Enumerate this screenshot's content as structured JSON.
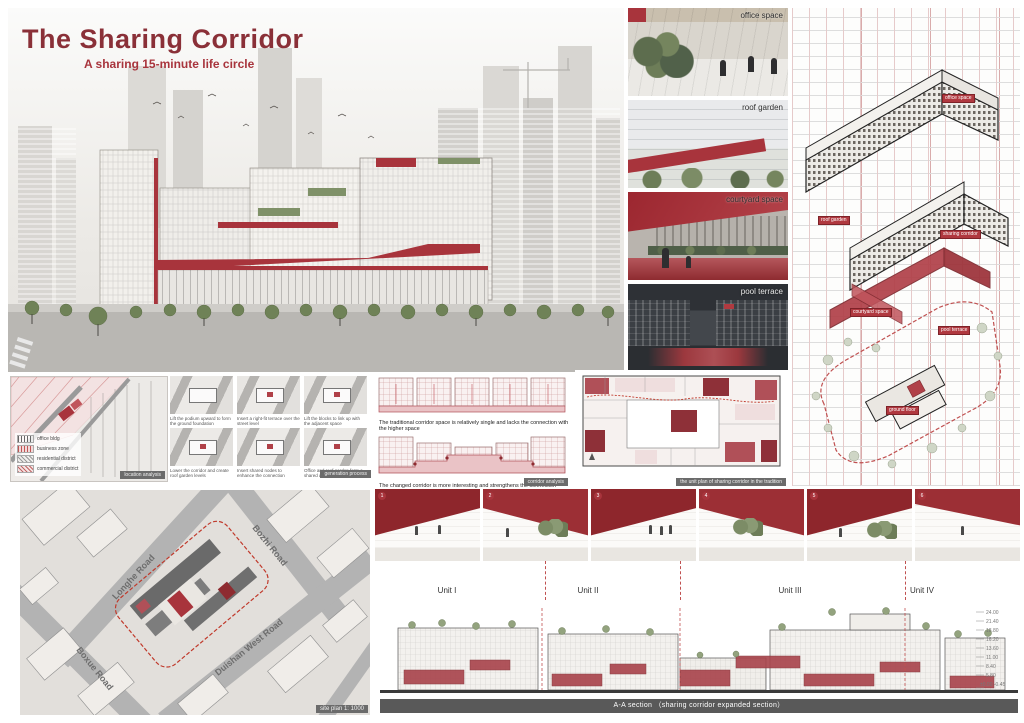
{
  "board": {
    "title": "The Sharing Corridor",
    "subtitle": "A sharing 15-minute life circle"
  },
  "photos": {
    "items": [
      {
        "label": "office space"
      },
      {
        "label": "roof garden"
      },
      {
        "label": "courtyard space"
      },
      {
        "label": "pool terrace"
      }
    ]
  },
  "axon": {
    "labels": [
      "office space",
      "roof garden",
      "sharing corridor",
      "courtyard space",
      "pool terrace",
      "ground floor"
    ]
  },
  "location_map": {
    "legend": [
      {
        "label": "office bldg"
      },
      {
        "label": "business zone"
      },
      {
        "label": "residential district"
      },
      {
        "label": "commercial district"
      }
    ],
    "badge": "location analysis"
  },
  "concept": {
    "badge": "generation process",
    "steps": [
      {
        "caption": "Lift the podium upward to form the ground foundation"
      },
      {
        "caption": "Insert a right-fit terrace over the street level"
      },
      {
        "caption": "Lift the blocks to link up with the adjacent space"
      },
      {
        "caption": "Lower the corridor and create roof garden levels"
      },
      {
        "caption": "Insert shared nodes to enhance the connection"
      },
      {
        "caption": "Office and roof garden form a shared district"
      }
    ]
  },
  "corridor_panel": {
    "text1": "The traditional corridor space is relatively single and lacks the connection with the higher space",
    "text2": "The changed corridor is more interesting and strengthens the connection between the corridor and various spaces",
    "badge": "corridor analysis"
  },
  "plans": {
    "caption": "the unit plan of sharing corridor in the tradition"
  },
  "site_plan": {
    "roads": {
      "bozhi": "Bozhi Road",
      "longhe": "Longhe Road",
      "boxue": "Boxue Road",
      "duishan": "Duishan West Road"
    },
    "badge": "site plan 1: 1000"
  },
  "vignettes": {
    "numbers": [
      "1",
      "2",
      "3",
      "4",
      "5",
      "6"
    ]
  },
  "section": {
    "units": [
      "Unit I",
      "Unit II",
      "Unit III",
      "Unit IV"
    ],
    "levels": [
      "24.00",
      "21.40",
      "18.80",
      "16.20",
      "13.60",
      "11.00",
      "8.40",
      "5.80",
      "±0.00 -0.45"
    ],
    "caption": "A-A section （sharing corridor expanded section）"
  }
}
